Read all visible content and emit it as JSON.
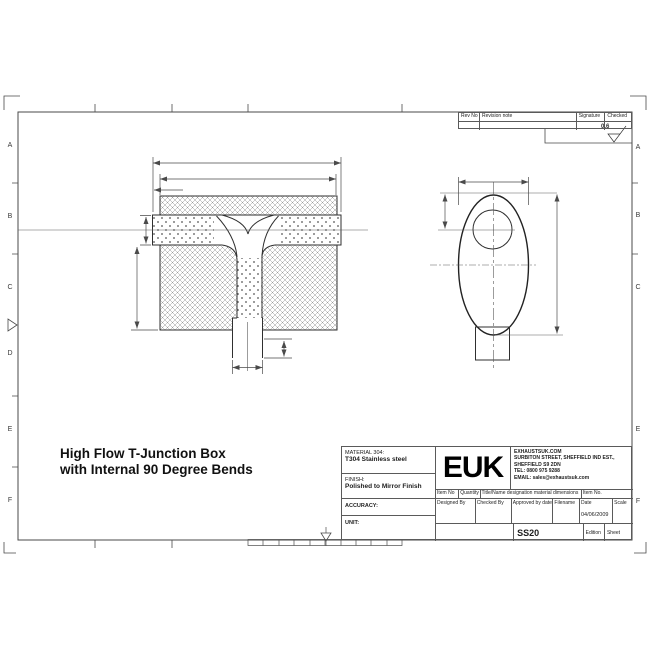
{
  "note": {
    "line1": "High Flow T-Junction Box",
    "line2": "with Internal 90 Degree Bends"
  },
  "frame": {
    "row_labels": [
      "A",
      "B",
      "C",
      "D",
      "E",
      "F"
    ],
    "surface_finish_value": "0.6"
  },
  "revision_table": {
    "rev_no": "Rev No",
    "revision_note": "Revision note",
    "signature": "Signature",
    "checked": "Checked"
  },
  "title_block": {
    "material_label": "MATERIAL 304:",
    "material_value": "T304 Stainless steel",
    "finish_label": "FINISH:",
    "finish_value": "Polished to Mirror Finish",
    "accuracy_label": "ACCURACY:",
    "unit_label": "UNIT:",
    "logo": "EUK",
    "address_lines": {
      "l1": "EXHAUSTSUK.COM",
      "l2": "SURBITON STREET, SHEFFIELD IND EST.,",
      "l3": "SHEFFIELD S9 2DN",
      "l4": "TEL: 0800 975 9288",
      "l5": "EMAIL: sales@exhaustsuk.com"
    },
    "parts_headers": {
      "item_no": "Item No",
      "quantity": "Quantity",
      "designation": "Title/Name designation material dimensions",
      "item_no2": "Item No."
    },
    "approval_headers": {
      "designed": "Designed By",
      "checked": "Checked By",
      "approved": "Approved by date",
      "filename": "Filename",
      "date": "Date",
      "scale": "Scale"
    },
    "date_value": "04/06/2009",
    "drawing_number": "SS20",
    "edition_label": "Edition",
    "sheet_label": "Sheet"
  },
  "colors": {
    "object_line": "#2f2f2f",
    "dim_line": "#4a4a4a",
    "border_line": "#5a5a5a",
    "text": "#1c1c1c"
  }
}
